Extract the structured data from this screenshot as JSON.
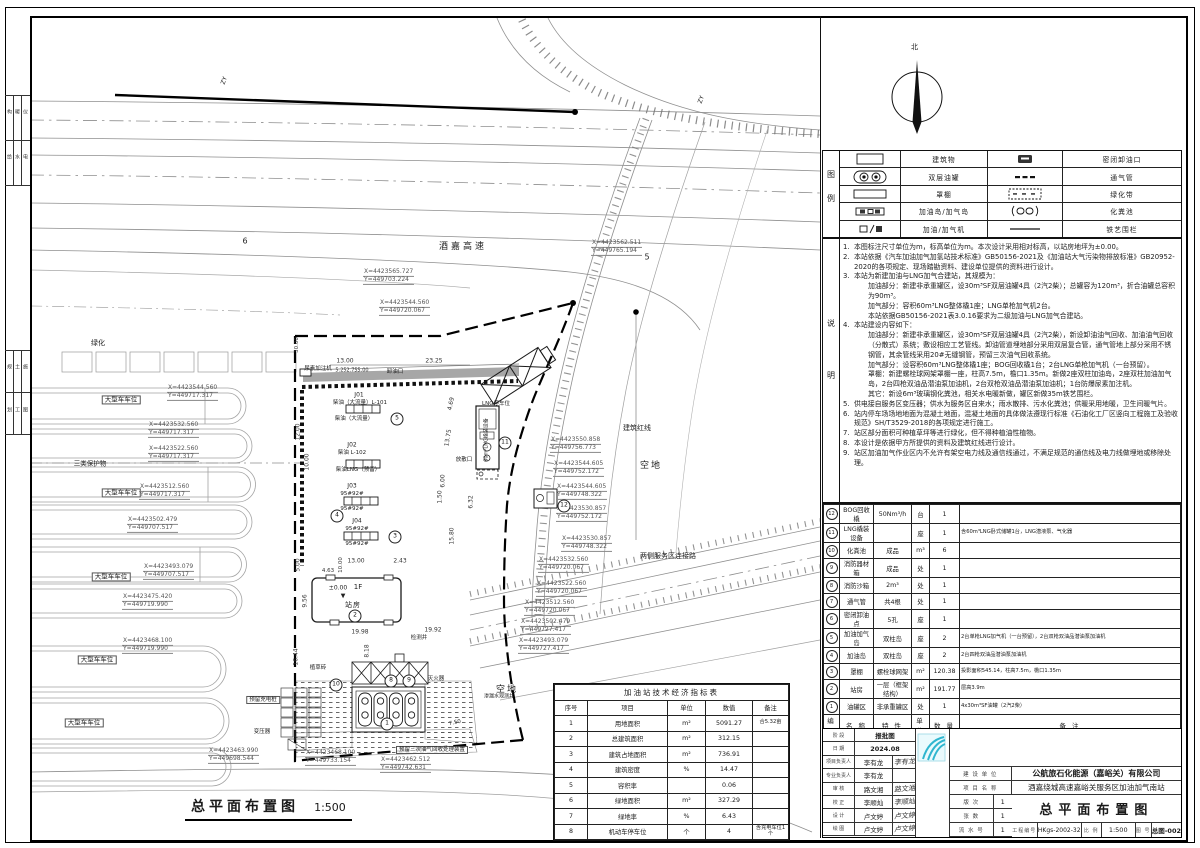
{
  "margin": {
    "rows": [
      [
        "构",
        "暖",
        "仪"
      ],
      [
        "给",
        "水",
        "电"
      ],
      [
        "规",
        "土",
        "施"
      ],
      [
        "划",
        "工",
        "图"
      ]
    ]
  },
  "north": {
    "label": "北"
  },
  "legend": {
    "col_label": "图例",
    "rows": [
      {
        "sym1": "building",
        "t1": "建筑物",
        "sym2": "unload",
        "t2": "密闭卸油口"
      },
      {
        "sym1": "dtank",
        "t1": "双层油罐",
        "sym2": "vent",
        "t2": "通气管"
      },
      {
        "sym1": "canopy",
        "t1": "罩棚",
        "sym2": "green",
        "t2": "绿化带"
      },
      {
        "sym1": "island",
        "t1": "加油岛/加气岛",
        "sym2": "septic",
        "t2": "化粪池"
      },
      {
        "sym1": "disp",
        "t1": "加油/加气机",
        "sym2": "fence",
        "t2": "铁艺围栏"
      }
    ]
  },
  "notes": {
    "col_label": "说明",
    "items": [
      {
        "n": "1.",
        "t": "本图标注尺寸单位为m，标高单位为m。本次设计采用相对标高，以站房地坪为±0.00。"
      },
      {
        "n": "2.",
        "t": "本站依据《汽车加油加气加氢站技术标准》GB50156-2021及《加油站大气污染物排放标准》GB20952-2020的各项规定、现场踏勘资料、建设单位提供的资料进行设计。"
      },
      {
        "n": "3.",
        "t": "本站为新建加油与LNG加气合建站，其规模为："
      },
      {
        "n": "",
        "t": "加油部分：新建非承重罐区，设30m³SF双层油罐4具（2汽2柴）；总罐容为120m³，折合油罐总容积为90m³。",
        "ind": 1
      },
      {
        "n": "",
        "t": "加气部分：容积60m³LNG整体橇1座；LNG单枪加气机2台。",
        "ind": 1
      },
      {
        "n": "",
        "t": "本站依据GB50156-2021表3.0.16要求为二级加油与LNG加气合建站。",
        "ind": 1
      },
      {
        "n": "4.",
        "t": "本站建设内容如下："
      },
      {
        "n": "",
        "t": "加油部分：新建非承重罐区，设30m³SF双层油罐4具（2汽2柴），新设卸油油气回收、加油油气回收（分散式）系统；敷设相应工艺管线。卸油管道埋地部分采用双层复合管，通气管地上部分采用不锈钢管，其余管线采用20#无缝钢管，预留三次油气回收系统。",
        "ind": 1
      },
      {
        "n": "",
        "t": "加气部分：设容积60m³LNG整体橇1座；BOG回收橇1台；2台LNG单枪加气机（一台预留）。",
        "ind": 1
      },
      {
        "n": "",
        "t": "罩棚：新建螺栓球网架罩棚一座，柱高7.5m，檐口1.35m。新做2座双柱加油岛，2座双柱加油加气岛，2台四枪双油品潜油泵加油机，2台双枪双油品潜油泵加油机；1台防爆尿素加注机。",
        "ind": 1
      },
      {
        "n": "",
        "t": "其它：新设6m³玻璃钢化粪池，相关水电暖新做，罐区新做35m铁艺围栏。",
        "ind": 1
      },
      {
        "n": "5.",
        "t": "供电接自服务区变压器；供水为服务区自来水；雨水散排、污水化粪池；供暖采用地暖，卫生间暖气片。"
      },
      {
        "n": "6.",
        "t": "站内停车场场地地面为混凝土地面，混凝土地面的具体做法遵现行标准《石油化工厂区竖向工程施工及验收规范》SH/T3529-2018的各项规定进行施工。"
      },
      {
        "n": "7.",
        "t": "站区部分面积可种植草坪等进行绿化，但不得种植油性植物。"
      },
      {
        "n": "8.",
        "t": "本设计是依据甲方所提供的资料及建筑红线进行设计。"
      },
      {
        "n": "9.",
        "t": "站区加油加气作业区内不允许有架空电力线及通信线通过，不满足规范的通信线及电力线做埋地或移除处理。"
      }
    ]
  },
  "building_table": {
    "title": "建（构）筑 物 一 览 表",
    "headers": [
      "编号",
      "名 称",
      "特 性",
      "单位",
      "数 量",
      "备  注"
    ],
    "rows": [
      [
        "12",
        "BOG回收橇",
        "50Nm³/h",
        "台",
        "1",
        ""
      ],
      [
        "11",
        "LNG橇装设备",
        "",
        "座",
        "1",
        "含60m³LNG卧式储罐1台，LNG潜液泵、气化器"
      ],
      [
        "10",
        "化粪池",
        "成品",
        "m³",
        "6",
        ""
      ],
      [
        "9",
        "消防器材箱",
        "成品",
        "处",
        "1",
        ""
      ],
      [
        "8",
        "消防沙箱",
        "2m³",
        "处",
        "1",
        ""
      ],
      [
        "7",
        "通气管",
        "共4根",
        "处",
        "1",
        ""
      ],
      [
        "6",
        "密闭卸油点",
        "5孔",
        "座",
        "1",
        ""
      ],
      [
        "5",
        "加油加气岛",
        "双柱岛",
        "座",
        "2",
        "2台单枪LNG加气机（一台预留），2台双枪双油品潜油泵加油机"
      ],
      [
        "4",
        "加油岛",
        "双柱岛",
        "座",
        "2",
        "2台四枪双油品潜油泵加油机"
      ],
      [
        "3",
        "罩棚",
        "螺栓球网架",
        "m²",
        "120.38",
        "投影面积545.14，柱高7.5m，檐口1.35m"
      ],
      [
        "2",
        "站房",
        "一层（框架结构）",
        "m²",
        "191.77",
        "层高3.9m"
      ],
      [
        "1",
        "油罐区",
        "非承重罐区",
        "处",
        "1",
        "4x30m³SF油罐（2汽2柴）"
      ]
    ]
  },
  "econ_table": {
    "title": "加油站技术经济指标表",
    "headers": [
      "序号",
      "项目",
      "单位",
      "数值",
      "备注"
    ],
    "rows": [
      [
        "1",
        "用地面积",
        "m²",
        "5091.27",
        "合5.32亩"
      ],
      [
        "2",
        "总建筑面积",
        "m²",
        "312.15",
        ""
      ],
      [
        "3",
        "建筑占地面积",
        "m²",
        "736.91",
        ""
      ],
      [
        "4",
        "建筑密度",
        "%",
        "14.47",
        ""
      ],
      [
        "5",
        "容积率",
        "",
        "0.06",
        ""
      ],
      [
        "6",
        "绿地面积",
        "m²",
        "327.29",
        ""
      ],
      [
        "7",
        "绿地率",
        "%",
        "6.43",
        ""
      ],
      [
        "8",
        "机动车停车位",
        "个",
        "4",
        "含充电车位1个"
      ]
    ]
  },
  "title_block": {
    "personnel": [
      {
        "l": "阶 段",
        "v": "报批图",
        "s": ""
      },
      {
        "l": "日 期",
        "v": "2024.08",
        "s": ""
      },
      {
        "l": "项目负责人",
        "v": "李有龙",
        "s": "李有龙"
      },
      {
        "l": "专业负责人",
        "v": "李有龙",
        "s": ""
      },
      {
        "l": "审 核",
        "v": "路文湘",
        "s": "路文湘"
      },
      {
        "l": "校 正",
        "v": "李顺灿",
        "s": "李顺灿"
      },
      {
        "l": "设 计",
        "v": "卢文婷",
        "s": "卢文婷"
      },
      {
        "l": "绘 图",
        "v": "卢文婷",
        "s": "卢文婷"
      }
    ],
    "mid": [
      {
        "l": "建 设 单 位",
        "v": ""
      },
      {
        "l": "项 目 名 称",
        "v": ""
      },
      {
        "l": "版  次",
        "v": "1"
      },
      {
        "l": "张  数",
        "v": "1"
      },
      {
        "l": "流 水 号",
        "v": "1"
      }
    ],
    "company": "公航旅石化能源（嘉峪关）有限公司",
    "project": "酒嘉绕城高速嘉峪关服务区加油加气南站",
    "drawing_title": "总平面布置图",
    "no_label": "工程编号",
    "no": "HKgs-2002-32",
    "scale_label": "比 例",
    "scale": "1:500",
    "fig_label": "图 号",
    "fig": "总图-002"
  },
  "plan": {
    "title": "总平面布置图",
    "scale": "1:500",
    "labels": [
      {
        "t": "酒嘉高速",
        "x": 463,
        "y": 248,
        "fs": 9,
        "ls": 3,
        "name": "road-label-expressway"
      },
      {
        "t": "空地",
        "x": 651,
        "y": 467,
        "fs": 9,
        "ls": 2,
        "name": "vacant-land-label"
      },
      {
        "t": "空地",
        "x": 507,
        "y": 691,
        "fs": 9,
        "ls": 2,
        "name": "vacant-land-label"
      },
      {
        "t": "建筑红线",
        "x": 637,
        "y": 429,
        "fs": 7,
        "name": "red-line-label"
      },
      {
        "t": "两侧服务区连接路",
        "x": 668,
        "y": 557,
        "fs": 7,
        "name": "connector-road-label"
      },
      {
        "t": "6",
        "x": 245,
        "y": 242,
        "fs": 8
      },
      {
        "t": "5",
        "x": 647,
        "y": 258,
        "fs": 8
      },
      {
        "t": "ZY",
        "x": 225,
        "y": 81,
        "fs": 6,
        "rot": -70
      },
      {
        "t": "ZY",
        "x": 702,
        "y": 100,
        "fs": 6,
        "rot": -70
      },
      {
        "t": "绿化",
        "x": 98,
        "y": 344,
        "fs": 7
      },
      {
        "t": "大型车车位",
        "x": 121,
        "y": 400,
        "fs": 6.5,
        "bx": 1
      },
      {
        "t": "三类保护物",
        "x": 90,
        "y": 464,
        "fs": 6.5
      },
      {
        "t": "大型车车位",
        "x": 121,
        "y": 493,
        "fs": 6.5,
        "bx": 1
      },
      {
        "t": "大型车车位",
        "x": 111,
        "y": 577,
        "fs": 6.5,
        "bx": 1
      },
      {
        "t": "大型车车位",
        "x": 97,
        "y": 660,
        "fs": 6.5,
        "bx": 1
      },
      {
        "t": "大型车车位",
        "x": 84,
        "y": 723,
        "fs": 6.5,
        "bx": 1
      },
      {
        "cls": "coord",
        "x": 363,
        "y": 277,
        "lines": [
          "X=4423565.727",
          "Y=449703.224"
        ]
      },
      {
        "cls": "coord",
        "x": 379,
        "y": 308,
        "lines": [
          "X=4423544.560",
          "Y=449720.067"
        ]
      },
      {
        "cls": "coord",
        "x": 591,
        "y": 248,
        "lines": [
          "X=4423562.511",
          "Y=449765.194"
        ]
      },
      {
        "cls": "coord",
        "x": 167,
        "y": 393,
        "lines": [
          "X=4423544.560",
          "Y=449717.317"
        ]
      },
      {
        "cls": "coord",
        "x": 148,
        "y": 430,
        "lines": [
          "X=4423532.560",
          "Y=449717.317"
        ]
      },
      {
        "cls": "coord",
        "x": 148,
        "y": 454,
        "lines": [
          "X=4423522.560",
          "Y=449717.317"
        ]
      },
      {
        "cls": "coord",
        "x": 139,
        "y": 492,
        "lines": [
          "X=4423512.560",
          "Y=449717.317"
        ]
      },
      {
        "cls": "coord",
        "x": 127,
        "y": 525,
        "lines": [
          "X=4423502.479",
          "Y=449707.517"
        ]
      },
      {
        "cls": "coord",
        "x": 143,
        "y": 572,
        "lines": [
          "X=4423493.079",
          "Y=449707.517"
        ]
      },
      {
        "cls": "coord",
        "x": 550,
        "y": 445,
        "lines": [
          "X=4423550.858",
          "Y=449756.773"
        ]
      },
      {
        "cls": "coord",
        "x": 553,
        "y": 469,
        "lines": [
          "X=4423544.605",
          "Y=449752.172"
        ]
      },
      {
        "cls": "coord",
        "x": 556,
        "y": 492,
        "lines": [
          "X=4423544.605",
          "Y=449748.322"
        ]
      },
      {
        "cls": "coord",
        "x": 556,
        "y": 514,
        "lines": [
          "X=4423530.857",
          "Y=449752.172"
        ]
      },
      {
        "cls": "coord",
        "x": 561,
        "y": 544,
        "lines": [
          "X=4423530.857",
          "Y=449748.322"
        ]
      },
      {
        "cls": "coord",
        "x": 538,
        "y": 565,
        "lines": [
          "X=4423532.560",
          "Y=449720.067"
        ]
      },
      {
        "cls": "coord",
        "x": 536,
        "y": 589,
        "lines": [
          "X=4423522.560",
          "Y=449720.067"
        ]
      },
      {
        "cls": "coord",
        "x": 524,
        "y": 608,
        "lines": [
          "X=4423512.560",
          "Y=449720.067"
        ]
      },
      {
        "cls": "coord",
        "x": 520,
        "y": 627,
        "lines": [
          "X=4423502.479",
          "Y=449727.417"
        ]
      },
      {
        "cls": "coord",
        "x": 518,
        "y": 646,
        "lines": [
          "X=4423493.079",
          "Y=449727.417"
        ]
      },
      {
        "cls": "coord",
        "x": 122,
        "y": 602,
        "lines": [
          "X=4423475.420",
          "Y=449719.990"
        ]
      },
      {
        "cls": "coord",
        "x": 122,
        "y": 646,
        "lines": [
          "X=4423468.100",
          "Y=449719.990"
        ]
      },
      {
        "cls": "coord",
        "x": 208,
        "y": 756,
        "lines": [
          "X=4423463.990",
          "Y=449698.544"
        ]
      },
      {
        "cls": "coord",
        "x": 305,
        "y": 758,
        "lines": [
          "X=4423468.100",
          "Y=449733.154"
        ]
      },
      {
        "cls": "coord",
        "x": 380,
        "y": 765,
        "lines": [
          "X=4423462.512",
          "Y=449742.631"
        ]
      },
      {
        "t": "尿素加注机",
        "x": 318,
        "y": 369,
        "fs": 5.5
      },
      {
        "t": "卸油口",
        "x": 395,
        "y": 372,
        "fs": 5.5
      },
      {
        "t": "J01",
        "x": 359,
        "y": 396,
        "fs": 6
      },
      {
        "t": "柴油（大流量）L-101",
        "x": 360,
        "y": 403,
        "fs": 5.5
      },
      {
        "t": "柴油（大流量）",
        "x": 354,
        "y": 419,
        "fs": 5.5
      },
      {
        "cls": "circ",
        "t": "5",
        "x": 397,
        "y": 419
      },
      {
        "t": "J02",
        "x": 352,
        "y": 446,
        "fs": 6
      },
      {
        "t": "柴油 L-102",
        "x": 352,
        "y": 453,
        "fs": 5.5
      },
      {
        "t": "柴油LNG（预留）",
        "x": 358,
        "y": 470,
        "fs": 5.5
      },
      {
        "t": "J03",
        "x": 352,
        "y": 487,
        "fs": 6
      },
      {
        "t": "95#92#",
        "x": 352,
        "y": 494,
        "fs": 5.5
      },
      {
        "t": "95#92#",
        "x": 352,
        "y": 509,
        "fs": 5.5
      },
      {
        "cls": "circ",
        "t": "4",
        "x": 337,
        "y": 516
      },
      {
        "t": "J04",
        "x": 357,
        "y": 522,
        "fs": 6
      },
      {
        "t": "95#92#",
        "x": 357,
        "y": 529,
        "fs": 5.5
      },
      {
        "t": "95#92#",
        "x": 357,
        "y": 544,
        "fs": 5.5
      },
      {
        "cls": "circ",
        "t": "3",
        "x": 395,
        "y": 537
      },
      {
        "t": "LNG停车位",
        "x": 496,
        "y": 404,
        "fs": 5.5
      },
      {
        "t": "60m³LNG橇装设备",
        "x": 487,
        "y": 440,
        "fs": 5,
        "rot": -90
      },
      {
        "t": "放散口",
        "x": 464,
        "y": 460,
        "fs": 5.5
      },
      {
        "cls": "circ",
        "t": "11",
        "x": 505,
        "y": 443
      },
      {
        "cls": "circ",
        "t": "12",
        "x": 564,
        "y": 506
      },
      {
        "t": "±0.00",
        "x": 338,
        "y": 589,
        "fs": 6
      },
      {
        "t": "1F",
        "x": 358,
        "y": 588,
        "fs": 7
      },
      {
        "t": "▼",
        "x": 343,
        "y": 597,
        "fs": 6
      },
      {
        "t": "站房",
        "x": 353,
        "y": 606,
        "fs": 7,
        "ls": 1
      },
      {
        "cls": "circ",
        "t": "2",
        "x": 355,
        "y": 616
      },
      {
        "t": "检测井",
        "x": 419,
        "y": 638,
        "fs": 5.5
      },
      {
        "t": "植草砖",
        "x": 318,
        "y": 668,
        "fs": 5.5
      },
      {
        "t": "预留充电桩",
        "x": 263,
        "y": 700,
        "fs": 5.5,
        "bx": 1
      },
      {
        "t": "变压器",
        "x": 262,
        "y": 732,
        "fs": 5.5
      },
      {
        "t": "灭火器",
        "x": 436,
        "y": 679,
        "fs": 5.5
      },
      {
        "t": "渗漏水观测井",
        "x": 499,
        "y": 697,
        "fs": 5
      },
      {
        "cls": "circ",
        "t": "8",
        "x": 391,
        "y": 681
      },
      {
        "cls": "circ",
        "t": "9",
        "x": 409,
        "y": 681
      },
      {
        "cls": "circ",
        "t": "10",
        "x": 336,
        "y": 685
      },
      {
        "cls": "circ",
        "t": "1",
        "x": 387,
        "y": 724
      },
      {
        "t": "预留三次油气回收处理装置",
        "x": 432,
        "y": 750,
        "fs": 5.5,
        "bx": 1
      },
      {
        "cls": "dim",
        "t": "13.00",
        "x": 345,
        "y": 362,
        "fs": 6
      },
      {
        "cls": "dim",
        "t": "23.25",
        "x": 434,
        "y": 362,
        "fs": 6
      },
      {
        "cls": "dim",
        "t": "5.25",
        "x": 341,
        "y": 371,
        "fs": 5
      },
      {
        "cls": "dim",
        "t": "2.75",
        "x": 352,
        "y": 371,
        "fs": 5
      },
      {
        "cls": "dim",
        "t": "5.00",
        "x": 363,
        "y": 371,
        "fs": 5
      },
      {
        "cls": "dim",
        "t": "30.00",
        "x": 297,
        "y": 345,
        "fs": 5.5,
        "rot": -90
      },
      {
        "cls": "dim",
        "t": "12.00",
        "x": 299,
        "y": 432,
        "fs": 6,
        "rot": -90
      },
      {
        "cls": "dim",
        "t": "10.00",
        "x": 308,
        "y": 462,
        "fs": 6,
        "rot": -90
      },
      {
        "cls": "dim",
        "t": "4.69",
        "x": 452,
        "y": 404,
        "fs": 6,
        "rot": -78
      },
      {
        "cls": "dim",
        "t": "13.75",
        "x": 449,
        "y": 438,
        "fs": 6,
        "rot": -80
      },
      {
        "cls": "dim",
        "t": "6.00",
        "x": 444,
        "y": 481,
        "fs": 6,
        "rot": -90
      },
      {
        "cls": "dim",
        "t": "1.50",
        "x": 441,
        "y": 497,
        "fs": 6,
        "rot": -90
      },
      {
        "cls": "dim",
        "t": "6.32",
        "x": 472,
        "y": 502,
        "fs": 6,
        "rot": -90
      },
      {
        "cls": "dim",
        "t": "15.80",
        "x": 453,
        "y": 536,
        "fs": 6,
        "rot": -90
      },
      {
        "cls": "dim",
        "t": "5.00",
        "x": 299,
        "y": 565,
        "fs": 6,
        "rot": -90
      },
      {
        "cls": "dim",
        "t": "9.56",
        "x": 306,
        "y": 601,
        "fs": 6,
        "rot": -90
      },
      {
        "cls": "dim",
        "t": "16.44",
        "x": 297,
        "y": 657,
        "fs": 6,
        "rot": -90
      },
      {
        "cls": "dim",
        "t": "4.63",
        "x": 328,
        "y": 571,
        "fs": 5.5
      },
      {
        "cls": "dim",
        "t": "10.00",
        "x": 341,
        "y": 565,
        "fs": 5.5,
        "rot": -90
      },
      {
        "cls": "dim",
        "t": "13.00",
        "x": 356,
        "y": 562,
        "fs": 6
      },
      {
        "cls": "dim",
        "t": "2.43",
        "x": 400,
        "y": 562,
        "fs": 6
      },
      {
        "cls": "dim",
        "t": "19.98",
        "x": 360,
        "y": 633,
        "fs": 6
      },
      {
        "cls": "dim",
        "t": "19.92",
        "x": 433,
        "y": 631,
        "fs": 6
      },
      {
        "cls": "dim",
        "t": "8.18",
        "x": 368,
        "y": 651,
        "fs": 6,
        "rot": -90
      },
      {
        "cls": "dim",
        "t": "7.50",
        "x": 455,
        "y": 723,
        "fs": 5.5,
        "rot": -12
      }
    ]
  }
}
